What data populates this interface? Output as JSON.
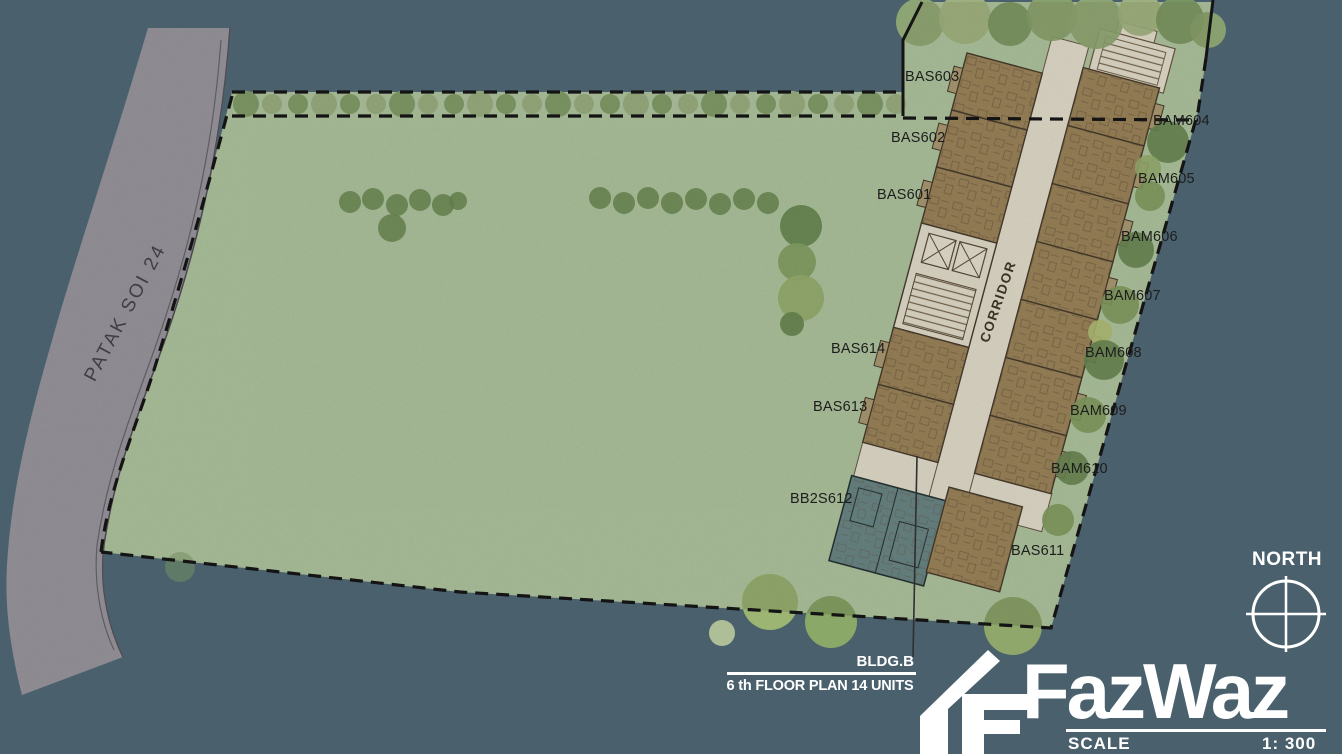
{
  "plan": {
    "road_label": "PATAK SOI 24",
    "corridor_label": "CORRIDOR",
    "north_label": "NORTH",
    "building_tag": "BLDG.B",
    "caption": "6 th FLOOR PLAN 14 UNITS",
    "scale_label": "SCALE",
    "scale_value": "1: 300"
  },
  "logo": {
    "text": "FazWaz"
  },
  "units": [
    {
      "label": "BAS603"
    },
    {
      "label": "BAS602"
    },
    {
      "label": "BAS601"
    },
    {
      "label": "BAS614"
    },
    {
      "label": "BAS613"
    },
    {
      "label": "BB2S612"
    },
    {
      "label": "BAM604"
    },
    {
      "label": "BAM605"
    },
    {
      "label": "BAM606"
    },
    {
      "label": "BAM607"
    },
    {
      "label": "BAM608"
    },
    {
      "label": "BAM609"
    },
    {
      "label": "BAM610"
    },
    {
      "label": "BAS611"
    }
  ],
  "colors": {
    "background": "#4a616d",
    "land": "#b7cda5",
    "road": "#a09ea4",
    "building_fill": "#a38a5e",
    "corridor_fill": "#ece6d3",
    "teal_unit_fill": "#6f8b8b",
    "boundary_line": "#141414",
    "label_text": "#1d1d1d",
    "overlay_text": "#ffffff"
  }
}
